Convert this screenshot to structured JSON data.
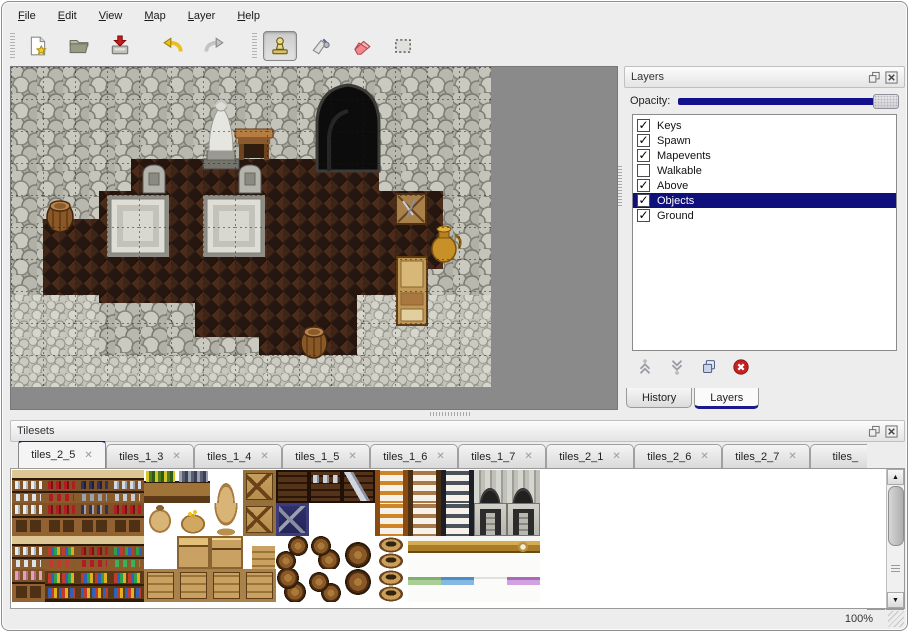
{
  "menu": {
    "items": [
      {
        "label": "File"
      },
      {
        "label": "Edit"
      },
      {
        "label": "View"
      },
      {
        "label": "Map"
      },
      {
        "label": "Layer"
      },
      {
        "label": "Help"
      }
    ]
  },
  "toolbar": {
    "file_group": [
      {
        "icon": "new-file"
      },
      {
        "icon": "open-folder"
      },
      {
        "icon": "save"
      }
    ],
    "history_group": [
      {
        "icon": "undo"
      },
      {
        "icon": "redo"
      }
    ],
    "tool_group": [
      {
        "icon": "stamp-tool",
        "active": true
      },
      {
        "icon": "fill-tool"
      },
      {
        "icon": "eraser-tool"
      },
      {
        "icon": "select-tool"
      }
    ]
  },
  "layers_panel": {
    "title": "Layers",
    "opacity_label": "Opacity:",
    "opacity_fraction": 1.0,
    "layers": [
      {
        "name": "Keys",
        "checked": true,
        "selected": false
      },
      {
        "name": "Spawn",
        "checked": true,
        "selected": false
      },
      {
        "name": "Mapevents",
        "checked": true,
        "selected": false
      },
      {
        "name": "Walkable",
        "checked": false,
        "selected": false
      },
      {
        "name": "Above",
        "checked": true,
        "selected": false
      },
      {
        "name": "Objects",
        "checked": true,
        "selected": true
      },
      {
        "name": "Ground",
        "checked": true,
        "selected": false
      }
    ],
    "actions": [
      {
        "icon": "move-up"
      },
      {
        "icon": "move-down"
      },
      {
        "icon": "duplicate-layer"
      },
      {
        "icon": "delete-layer"
      }
    ],
    "tabs": [
      {
        "label": "History",
        "active": false
      },
      {
        "label": "Layers",
        "active": true
      }
    ]
  },
  "tilesets_panel": {
    "title": "Tilesets",
    "tabs": [
      {
        "label": "tiles_2_5",
        "active": true
      },
      {
        "label": "tiles_1_3",
        "active": false
      },
      {
        "label": "tiles_1_4",
        "active": false
      },
      {
        "label": "tiles_1_5",
        "active": false
      },
      {
        "label": "tiles_1_6",
        "active": false
      },
      {
        "label": "tiles_1_7",
        "active": false
      },
      {
        "label": "tiles_2_1",
        "active": false
      },
      {
        "label": "tiles_2_6",
        "active": false
      },
      {
        "label": "tiles_2_7",
        "active": false
      },
      {
        "label": "tiles_",
        "active": false,
        "truncated": true
      }
    ],
    "tile_grid": [
      [
        "shelf-dishes",
        "shelf-red",
        "shelf-dark",
        "shelf-jars",
        "flowerbox",
        "graybox",
        "sack-top",
        "crate-x",
        "darkshelf",
        "darkshelf-metal",
        "darkshelf-z",
        "ladder-orange",
        "ladder-brown",
        "ladder-dark",
        "arch-top",
        "arch-top"
      ],
      [
        "cabinet-dishes",
        "cabinet-red",
        "cabinet-dark",
        "cabinet-red",
        "sack",
        "sack-gold",
        "sack-bottom",
        "crate-x",
        "graycrate",
        "empty",
        "empty",
        "ladder-orange",
        "ladder-brown",
        "ladder-dark",
        "arch-door",
        "arch-door"
      ],
      [
        "shelf-dishes",
        "shelf-goods",
        "shelf-red",
        "shelf-cans",
        "empty",
        "crate-top",
        "crate-lid",
        "crate-small",
        "barrels-a",
        "barrels-b",
        "barrel-top",
        "pots",
        "bed-head",
        "bed-head",
        "bed-head",
        "bed-head-fancy"
      ],
      [
        "cabinet-pink",
        "shelf-books",
        "shelf-books",
        "shelf-books",
        "crate",
        "crate",
        "crate",
        "crate",
        "barrels-c",
        "barrels-d",
        "barrel-bottom",
        "pots",
        "bed-green",
        "bed-blue",
        "bed-white",
        "bed-purple"
      ]
    ]
  },
  "status_bar": {
    "zoom_level": "100%"
  },
  "icons": {
    "tab_close": "✕",
    "scroll_left": "◀",
    "scroll_right": "▶",
    "scroll_up": "▲",
    "scroll_down": "▼",
    "check": "✓"
  },
  "colors": {
    "selection": "#10107c",
    "tab_accent": "#1c1a8a",
    "slider_fill": "#13128c",
    "canvas_backdrop": "#8a8a8a",
    "delete_red": "#c42222"
  }
}
